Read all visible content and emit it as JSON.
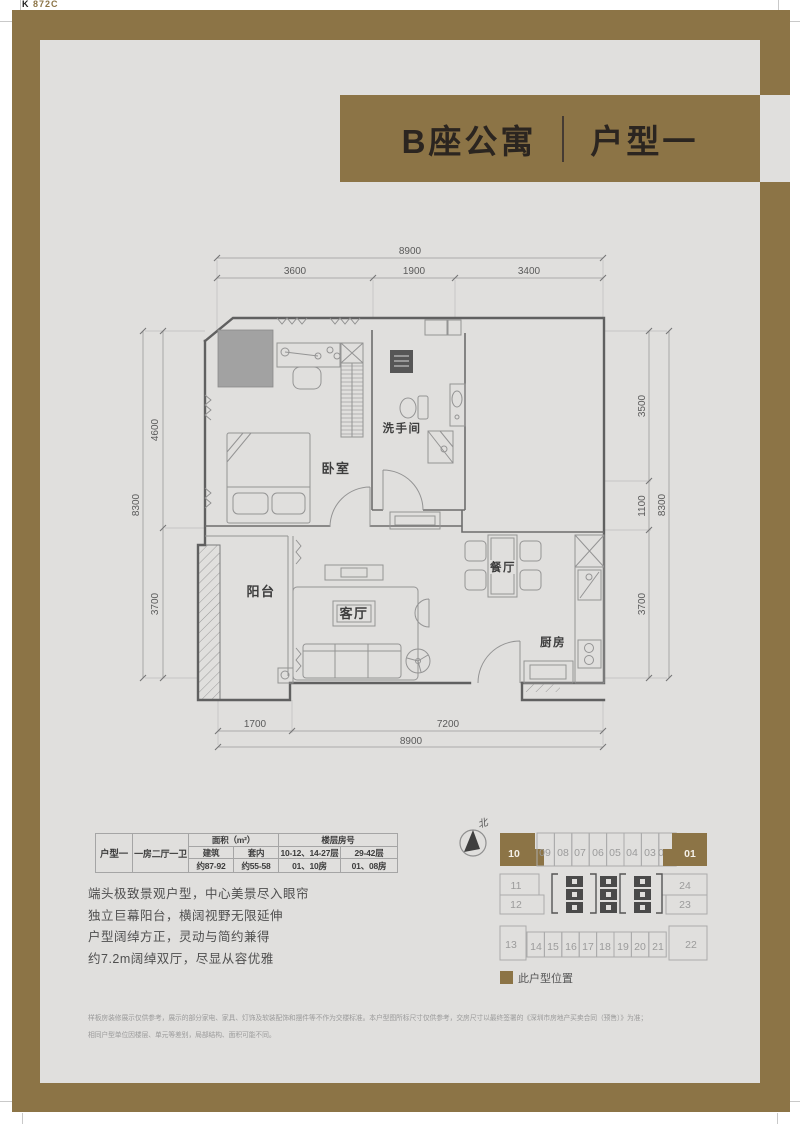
{
  "plate": {
    "k": "K",
    "code": "872C"
  },
  "banner": {
    "building": "B座公寓",
    "unit": "户型一"
  },
  "floorplan": {
    "rooms": {
      "bedroom": "卧室",
      "bathroom": "洗手间",
      "balcony": "阳台",
      "living": "客厅",
      "dining": "餐厅",
      "kitchen": "厨房"
    },
    "dims": {
      "top_total": "8900",
      "top_segs": [
        "3600",
        "1900",
        "3400"
      ],
      "left_total": "8300",
      "left_segs": [
        "4600",
        "3700"
      ],
      "right_segs": [
        "3500",
        "1100",
        "3700"
      ],
      "right_total": "8300",
      "bottom_segs": [
        "1700",
        "7200"
      ],
      "bottom_total": "8900"
    }
  },
  "spec_table": {
    "unit_name": "户型一",
    "unit_layout": "一房二厅一卫",
    "group_area": "面积（m²）",
    "group_floor": "楼层房号",
    "sub_headers": [
      "建筑",
      "套内",
      "10-12、14-27层",
      "29-42层"
    ],
    "values": [
      "约87-92",
      "约55-58",
      "01、10房",
      "01、08房"
    ]
  },
  "description": {
    "lines": [
      "端头极致景观户型，中心美景尽入眼帘",
      "独立巨幕阳台，横阔视野无限延伸",
      "户型阔绰方正，灵动与简约兼得",
      "约7.2m阔绰双厅，尽显从容优雅"
    ]
  },
  "keyplan": {
    "north_label": "北",
    "legend_label": "此户型位置",
    "top_row": [
      "10",
      "09",
      "08",
      "07",
      "06",
      "05",
      "04",
      "03",
      "02",
      "01"
    ],
    "mid_left": [
      "11",
      "12"
    ],
    "mid_right": [
      "24",
      "23"
    ],
    "bottom_row": [
      "13",
      "14",
      "15",
      "16",
      "17",
      "18",
      "19",
      "20",
      "21",
      "22"
    ]
  },
  "disclaimer": {
    "line1": "样板房装修展示仅供参考，展示的部分家电、家具、灯饰及软装配饰和摆件等不作为交楼标准。本户型图所标尺寸仅供参考，交房尺寸以最终签署的《深圳市房地产买卖合同（预售）》为准；",
    "line2": "相同户型单位因楼层、单元等差别，局部结构、面积可能不同。"
  },
  "colors": {
    "brand_brown": "#8c7446",
    "panel_gray": "#e0dfdd"
  }
}
